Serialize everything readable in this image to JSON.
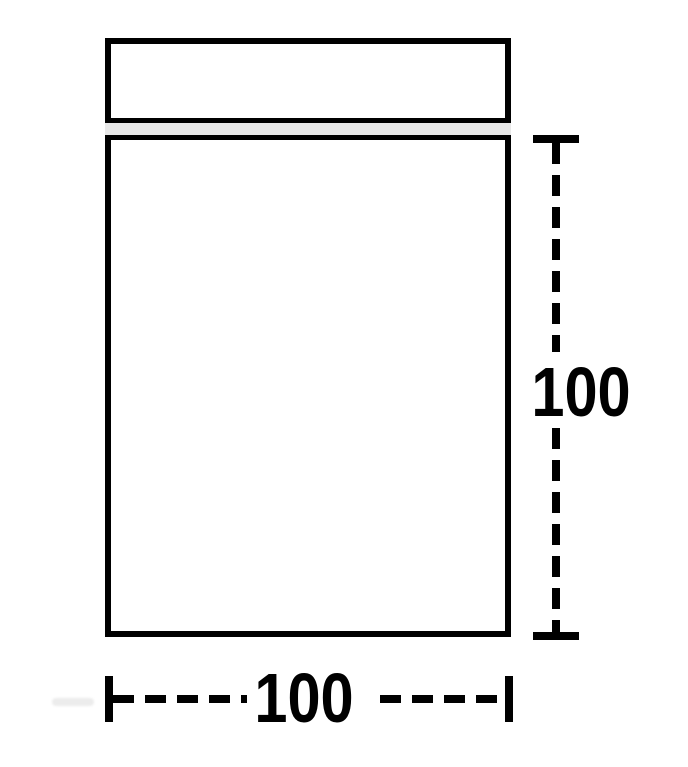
{
  "diagram": {
    "object": "bag-dimension-diagram",
    "labels": {
      "height": "100",
      "width": "100"
    },
    "colors": {
      "line": "#000000",
      "seal_fill": "#e8e8e8",
      "bag_fill": "#ffffff",
      "background": "#ffffff"
    }
  }
}
